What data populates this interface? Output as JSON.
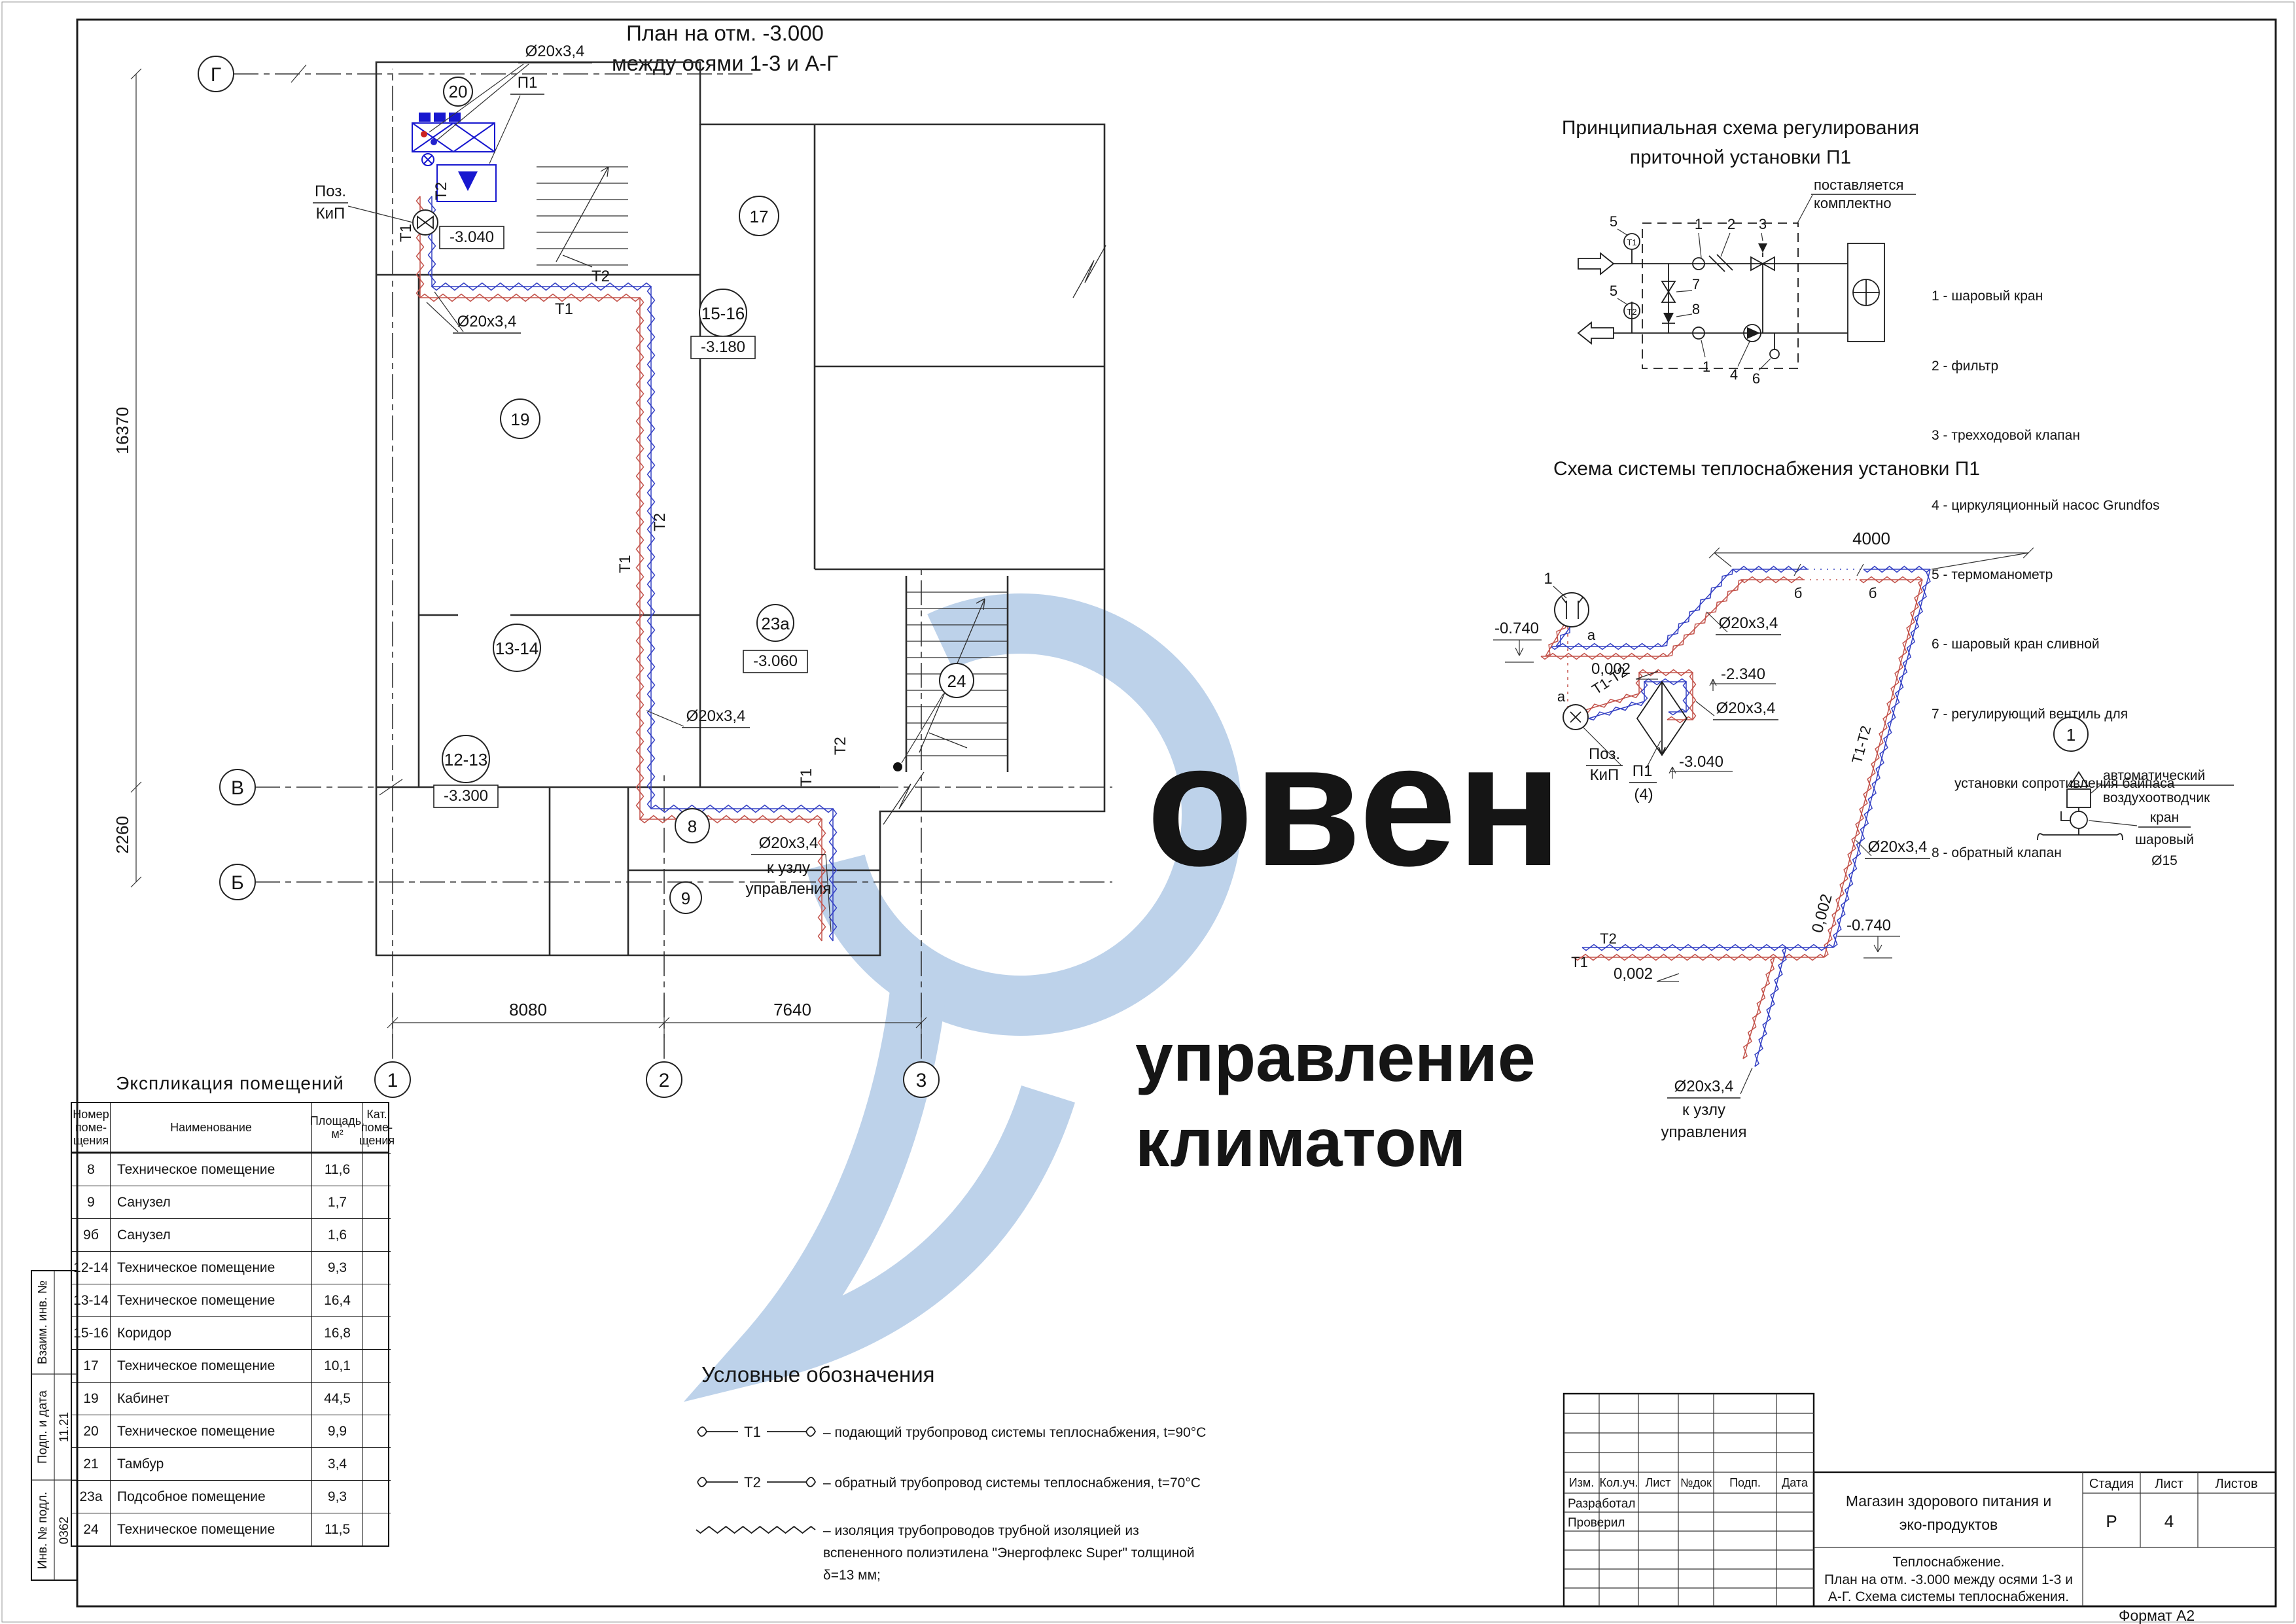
{
  "format_note": "Формат А2",
  "watermark": {
    "brand": "овен",
    "tag1": "управление",
    "tag2": "климатом"
  },
  "plan": {
    "title1": "План на отм. -3.000",
    "title2": "между осями 1-3 и А-Г",
    "axis": {
      "g": "Г",
      "v": "В",
      "b": "Б",
      "n1": "1",
      "n2": "2",
      "n3": "3"
    },
    "dim": {
      "w1": "8080",
      "w2": "7640",
      "h1": "16370",
      "h2": "2260"
    },
    "room": {
      "r20": "20",
      "r17": "17",
      "r19": "19",
      "r1516": "15-16",
      "r1314": "13-14",
      "r23a": "23а",
      "r1213": "12-13",
      "r8": "8",
      "r9": "9",
      "r24": "24"
    },
    "level": {
      "v3040": "-3.040",
      "v3180": "-3.180",
      "v3060": "-3.060",
      "v3300": "-3.300"
    },
    "lbl": {
      "d20": "Ø20x3,4",
      "t1": "Т1",
      "t2": "Т2",
      "p1": "П1",
      "poz1": "Поз.",
      "poz2": "КиП",
      "node1": "к узлу",
      "node2": "управления"
    }
  },
  "schematic": {
    "title1": "Принципиальная схема регулирования",
    "title2": "приточной установки П1",
    "note1": "поставляется",
    "note2": "комплектно",
    "t1": "Т1",
    "t2": "Т2",
    "c1": "1",
    "c2": "2",
    "c3": "3",
    "c4": "4",
    "c5": "5",
    "c6": "6",
    "c7": "7",
    "c8": "8",
    "legend": [
      "1 - шаровый кран",
      "2 - фильтр",
      "3 - трехходовой клапан",
      "4 - циркуляционный насос Grundfos",
      "5 - термоманометр",
      "6 - шаровый кран сливной",
      "7 - регулирующий вентиль для",
      "      установки сопротивления байпаса",
      "8 - обратный клапан"
    ]
  },
  "scheme": {
    "title": "Схема системы теплоснабжения установки П1",
    "dim4000": "4000",
    "slope": "0,002",
    "lvl074": "-0.740",
    "lvl234": "-2.340",
    "lvl304": "-3.040",
    "d20": "Ø20x3,4",
    "t1": "Т1",
    "t2": "Т2",
    "t1t2": "Т1-Т2",
    "a": "а",
    "b": "б",
    "n1": "1",
    "poz1": "Поз.",
    "poz2": "КиП",
    "p1": "П1",
    "p1n": "(4)",
    "node1": "к узлу",
    "node2": "управления",
    "det": {
      "n": "1",
      "a1": "автоматический",
      "a2": "воздухоотводчик",
      "k1": "кран",
      "k2": "шаровый",
      "k3": "Ø15"
    }
  },
  "expl": {
    "title": "Экспликация помещений",
    "h_num": "Номер\nпоме-\nщения",
    "h_name": "Наименование",
    "h_area": "Площадь,\nм²",
    "h_cat": "Кат.\nпоме-\nщения",
    "rows": [
      [
        "8",
        "Техническое помещение",
        "11,6"
      ],
      [
        "9",
        "Санузел",
        "1,7"
      ],
      [
        "9б",
        "Санузел",
        "1,6"
      ],
      [
        "12-14",
        "Техническое помещение",
        "9,3"
      ],
      [
        "13-14",
        "Техническое помещение",
        "16,4"
      ],
      [
        "15-16",
        "Коридор",
        "16,8"
      ],
      [
        "17",
        "Техническое помещение",
        "10,1"
      ],
      [
        "19",
        "Кабинет",
        "44,5"
      ],
      [
        "20",
        "Техническое помещение",
        "9,9"
      ],
      [
        "21",
        "Тамбур",
        "3,4"
      ],
      [
        "23а",
        "Подсобное помещение",
        "9,3"
      ],
      [
        "24",
        "Техническое помещение",
        "11,5"
      ]
    ]
  },
  "legend": {
    "title": "Условные обозначения",
    "s1": "Т1",
    "i1": "– подающий трубопровод системы теплоснабжения, t=90°С",
    "s2": "Т2",
    "i2": "– обратный трубопровод системы теплоснабжения, t=70°С",
    "i3a": "– изоляция трубопроводов трубной изоляцией из",
    "i3b": "вспененного полиэтилена \"Энергофлекс Super\" толщиной",
    "i3c": "δ=13 мм;"
  },
  "stamp": {
    "c1": "Изм.",
    "c2": "Кол.уч.",
    "c3": "Лист",
    "c4": "№док",
    "c5": "Подп.",
    "c6": "Дата",
    "r1": "Разработал",
    "r2": "Проверил",
    "p1": "Магазин здорового питания и",
    "p2": "эко-продуктов",
    "d1": "Теплоснабжение.",
    "d2": "План на отм. -3.000 между осями 1-3 и",
    "d3": "А-Г. Схема системы теплоснабжения.",
    "sh": "Стадия",
    "lh": "Лист",
    "lsh": "Листов",
    "sv": "Р",
    "lv": "4"
  },
  "margin": {
    "m1": "Взаим. инв. №",
    "m2": "Подп. и дата",
    "m2v": "11.21",
    "m3": "Инв. № подл.",
    "m3v": "0362"
  }
}
